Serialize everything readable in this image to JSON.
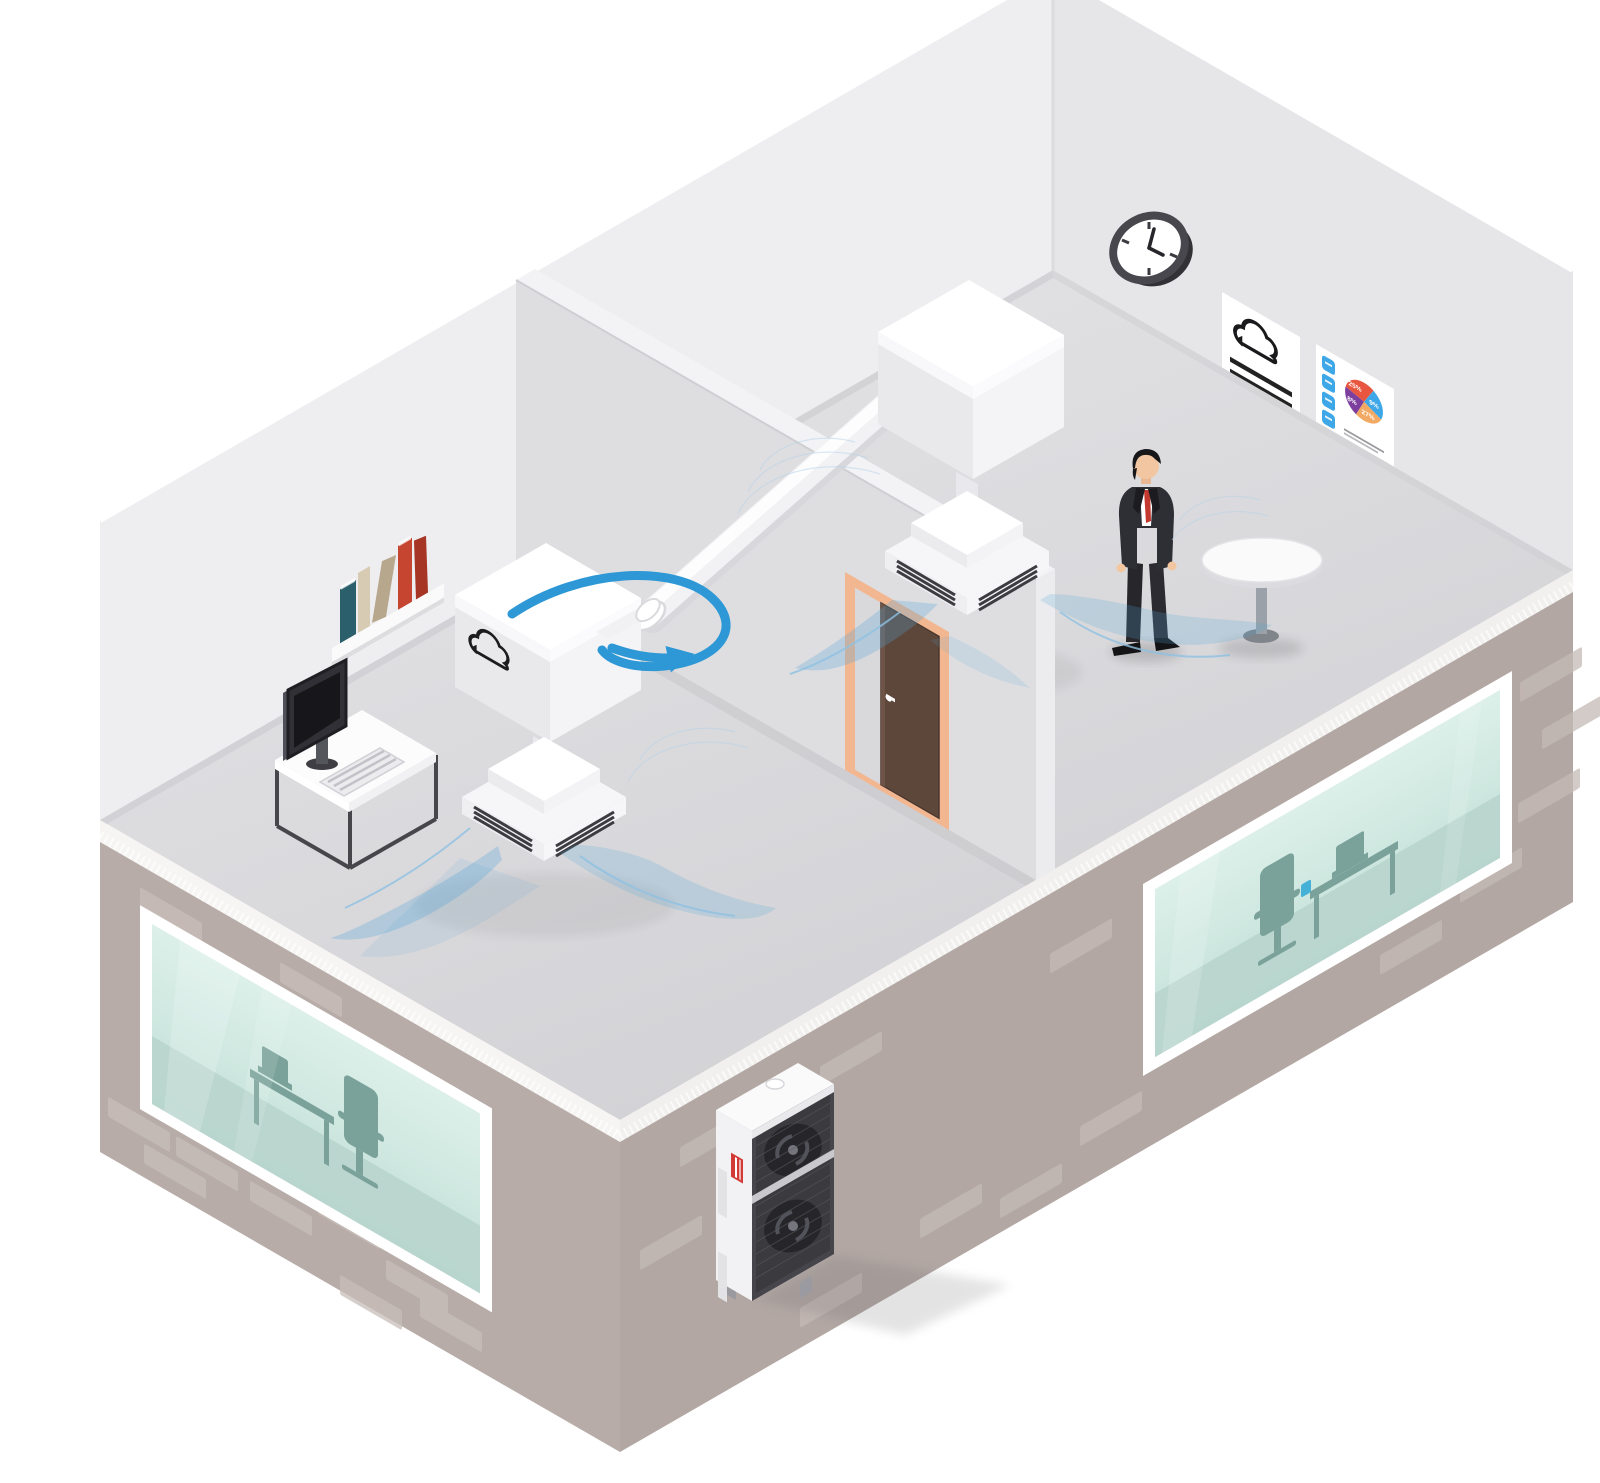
{
  "scene": {
    "description": "Isometric cutaway illustration of a two-room office with a ducted air-conditioning system",
    "background_color": "#ffffff"
  },
  "palette": {
    "floor": "#dfdfe2",
    "interior_wall_left": "#eeeef0",
    "interior_wall_right": "#e6e6e9",
    "partition": "#dedee1",
    "exterior_wall": "#b7aca8",
    "brick": "#c8beba",
    "slab_fringe": "#f6f5f3",
    "window_glass": "#cfe7e0",
    "glass_furniture": "#7aa29a",
    "unit_white": "#ffffff",
    "unit_shade": "#e9e9ec",
    "airflow_blue": "#57a7d8",
    "duct_arrow_blue": "#2d98d5",
    "door_frame": "#f2b790",
    "door_panel": "#5d463a",
    "suit": "#2e2e35",
    "tie": "#c4392f",
    "skin": "#f2c6a0",
    "clock_rim": "#47474d",
    "badge_red": "#e2493b",
    "pill_blue": "#3ea7e8",
    "book_colors": [
      "#2c5f6c",
      "#d8cbb4",
      "#b7a78d",
      "#c64531",
      "#a63525"
    ]
  },
  "left_room": {
    "items": [
      "wall-bookshelf",
      "computer-desk",
      "ceiling-duct-unit",
      "airflow"
    ],
    "unit_logo": "cloud"
  },
  "right_room": {
    "items": [
      "wall-clock",
      "document-poster",
      "analytics-poster",
      "standing-man",
      "round-table",
      "ceiling-duct-unit",
      "airflow"
    ]
  },
  "posters": {
    "document_poster": {
      "icon": "cloud",
      "line_count": 5
    },
    "analytics_poster": {
      "pie": {
        "labels": [
          "25%",
          "9%",
          "27%",
          "8%"
        ],
        "colors": [
          "#e8563f",
          "#3ea7e8",
          "#f2a963",
          "#7d3f9d"
        ]
      },
      "pill_count": 4,
      "badge_count": 4,
      "line_series": 2
    }
  },
  "clock": {
    "time": "4:00"
  },
  "outdoor_unit": {
    "fan_count": 2,
    "badge_color": "#d23b35"
  },
  "connections": {
    "duct": "right indoor unit connected to left indoor unit across the partition",
    "arrow": "blue airflow direction arrow around duct junction"
  }
}
